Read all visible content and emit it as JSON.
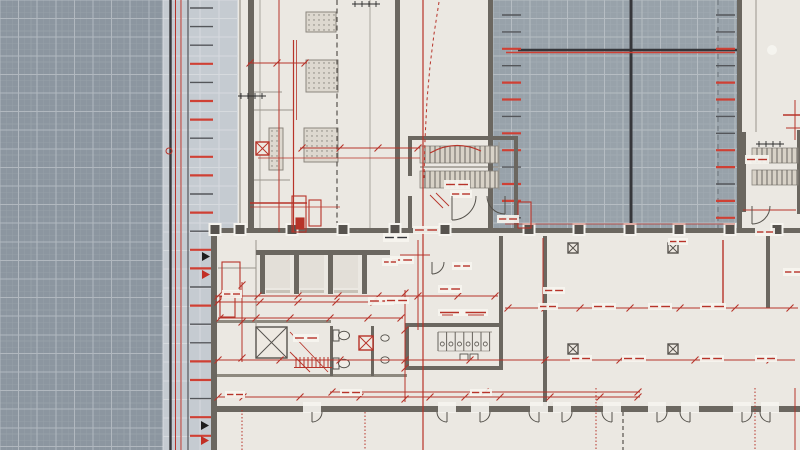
{
  "canvas": {
    "w": 800,
    "h": 450
  },
  "palette": {
    "paper": "#ebe8e2",
    "wall": "#6b6760",
    "wall_mid": "#8e897f",
    "line_gray": "#9a958c",
    "ink": "#35363a",
    "ink2": "#54565a",
    "red": "#b73329",
    "red_bright": "#cf4034",
    "tread": "#d8d2c7",
    "white": "#f6f4ef",
    "dot": "#6a665f",
    "fixture": "#55524c",
    "fixture_fill": "#f0ede7"
  },
  "grids": [
    {
      "name": "exterior-grid-left",
      "x": 0,
      "y": 0,
      "w": 163,
      "h": 450,
      "base": "#8c96a0",
      "minor": "#96a0a8",
      "major": "#b1b8bf",
      "ms": 6.2,
      "Ms": 18.6
    },
    {
      "name": "courtyard-grid",
      "x": 493,
      "y": 0,
      "w": 244,
      "h": 230,
      "base": "#98a2aa",
      "minor": "#a1aab1",
      "major": "#b6bdc3",
      "ms": 6.2,
      "Ms": 18.6
    }
  ],
  "bands": [
    {
      "name": "facade-band-upper",
      "x": 163,
      "y": 0,
      "w": 75,
      "h": 232,
      "base": "#c5cbd1",
      "line": "#d6dade",
      "Ms": 18.6
    },
    {
      "name": "facade-band-lower",
      "x": 163,
      "y": 232,
      "w": 48,
      "h": 218,
      "base": "#c5cbd1",
      "line": "#d6dade",
      "Ms": 18.6
    }
  ],
  "facade_lines": [
    [
      170.5,
      "ink",
      2.4
    ],
    [
      175.5,
      "red",
      1
    ],
    [
      181,
      "red",
      1
    ],
    [
      188,
      "ink2",
      1.2
    ]
  ],
  "facade_ticks": {
    "x1": 190,
    "x2": 213,
    "y0": 8,
    "step": 18.6,
    "colors": [
      "g",
      "g",
      "g",
      "r",
      "g",
      "r",
      "r",
      "g",
      "r",
      "r",
      "g",
      "r",
      "g",
      "r",
      "r",
      "g",
      "r",
      "g",
      "g",
      "r",
      "r",
      "g",
      "r",
      "r"
    ]
  },
  "court_ticks": [
    {
      "x1": 502,
      "x2": 521,
      "y0": 15,
      "step": 16.9,
      "colors": [
        "g",
        "g",
        "r",
        "g",
        "r",
        "r",
        "g",
        "r",
        "r",
        "g",
        "r",
        "r",
        "g"
      ]
    },
    {
      "x1": 716,
      "x2": 735,
      "y0": 15,
      "step": 16.9,
      "colors": [
        "g",
        "g",
        "r",
        "g",
        "r",
        "r",
        "g",
        "g",
        "r",
        "r",
        "g",
        "r",
        "r"
      ]
    }
  ],
  "court_cross": {
    "v": [
      631,
      0,
      230,
      3
    ],
    "h": [
      50,
      518,
      737,
      2.5
    ],
    "red_h": [
      52.5,
      506,
      735,
      1.5
    ],
    "dashed_v": [
      718,
      0,
      228
    ]
  },
  "walls": [
    [
      248,
      0,
      6,
      232
    ],
    [
      395,
      0,
      5,
      232
    ],
    [
      488,
      0,
      5,
      230
    ],
    [
      737,
      0,
      5,
      230
    ],
    [
      211,
      230,
      6,
      220
    ],
    [
      213,
      228,
      587,
      5
    ],
    [
      213,
      406,
      590,
      6
    ],
    [
      543,
      236,
      4,
      172
    ],
    [
      256,
      250,
      134,
      5
    ],
    [
      260,
      250,
      5,
      44
    ],
    [
      294,
      250,
      5,
      44
    ],
    [
      328,
      250,
      5,
      44
    ],
    [
      362,
      250,
      5,
      44
    ],
    [
      408,
      136,
      110,
      4
    ],
    [
      408,
      136,
      4,
      40
    ],
    [
      408,
      196,
      4,
      36
    ],
    [
      514,
      136,
      4,
      96
    ],
    [
      742,
      132,
      4,
      80
    ],
    [
      797,
      130,
      3,
      84
    ],
    [
      407,
      323,
      96,
      4
    ],
    [
      407,
      366,
      96,
      4
    ],
    [
      405,
      323,
      4,
      47
    ],
    [
      499,
      236,
      4,
      134
    ],
    [
      330,
      326,
      3,
      50
    ],
    [
      371,
      326,
      3,
      50
    ],
    [
      766,
      236,
      4,
      72
    ]
  ],
  "wall_mid_rects": [
    [
      213,
      320,
      118,
      3
    ],
    [
      213,
      374,
      194,
      3
    ]
  ],
  "wall_lines": [
    [
      240,
      0,
      240,
      232,
      1.2
    ],
    [
      260,
      0,
      260,
      232,
      0.8
    ],
    [
      370,
      0,
      370,
      232,
      0.8
    ],
    [
      248,
      92,
      282,
      92,
      1
    ],
    [
      248,
      110,
      294,
      110,
      1
    ],
    [
      254,
      180,
      290,
      180,
      1
    ],
    [
      756,
      0,
      756,
      132,
      1
    ],
    [
      499,
      142,
      499,
      190,
      1
    ],
    [
      420,
      167,
      498,
      167,
      1.4
    ],
    [
      218,
      268,
      256,
      268,
      1
    ],
    [
      256,
      240,
      256,
      330,
      1
    ],
    [
      438,
      332,
      492,
      332,
      1
    ],
    [
      438,
      351,
      490,
      351,
      0.8
    ]
  ],
  "dashed_dark": [
    [
      337,
      0,
      337,
      232,
      "5 3.5",
      1.2
    ],
    [
      623,
      412,
      623,
      450,
      "4 3",
      1.2
    ]
  ],
  "red_lines": [
    [
      423,
      0,
      423,
      450,
      1.2
    ],
    [
      258,
      158,
      420,
      158,
      0.8
    ],
    [
      250,
      203,
      307,
      203,
      1.6
    ],
    [
      250,
      207,
      340,
      207,
      0.8
    ],
    [
      279,
      0,
      279,
      232,
      1
    ],
    [
      293.5,
      40,
      293.5,
      232,
      1.2
    ],
    [
      296.5,
      40,
      296.5,
      120,
      0.8
    ],
    [
      543,
      238,
      543,
      307,
      1
    ],
    [
      723,
      240,
      723,
      307,
      1.4
    ],
    [
      783,
      115,
      800,
      115,
      1.5
    ],
    [
      786,
      128,
      800,
      128,
      1
    ],
    [
      795,
      100,
      795,
      140,
      1
    ],
    [
      418,
      240,
      418,
      330,
      1
    ],
    [
      400,
      255,
      430,
      255,
      1
    ],
    [
      743,
      210,
      796,
      210,
      1
    ],
    [
      795,
      388,
      795,
      450,
      1
    ],
    [
      505,
      224,
      735,
      224,
      0.8
    ]
  ],
  "red_dotted": [
    [
      242,
      410,
      242,
      450
    ],
    [
      365,
      412,
      365,
      450
    ],
    [
      596,
      388,
      596,
      450
    ],
    [
      755,
      388,
      755,
      450
    ]
  ],
  "red_paths": [
    {
      "d": "M439,2 L434,34 L430,66 L427,100 L425,140 L424,178",
      "dash": "3 3",
      "w": 1
    },
    {
      "d": "M430,153 Q455,139 481,151",
      "dash": "",
      "w": 1.1
    }
  ],
  "red_rects": [
    [
      292,
      196,
      14,
      36,
      0
    ],
    [
      309,
      200,
      12,
      26,
      0
    ],
    [
      296,
      218,
      8,
      11,
      1
    ],
    [
      222,
      262,
      18,
      30,
      0
    ],
    [
      220,
      297,
      15,
      20,
      0
    ],
    [
      518,
      202,
      13,
      26,
      0
    ]
  ],
  "dotted_rects": [
    [
      306,
      12,
      30,
      20
    ],
    [
      306,
      60,
      32,
      32
    ],
    [
      304,
      128,
      34,
      34
    ],
    [
      269,
      128,
      14,
      42
    ]
  ],
  "xboxes": [
    [
      256,
      142,
      13,
      "red"
    ],
    [
      256,
      327,
      31,
      "gray"
    ],
    [
      568,
      243,
      10,
      "gray"
    ],
    [
      668,
      243,
      10,
      "gray"
    ],
    [
      568,
      344,
      10,
      "gray"
    ],
    [
      668,
      344,
      10,
      "gray"
    ],
    [
      359,
      336,
      14,
      "red"
    ]
  ],
  "columns": {
    "y": 225,
    "s": 9,
    "xs": [
      215,
      240,
      292,
      343,
      395,
      445,
      529,
      579,
      630,
      679,
      730,
      777
    ]
  },
  "stairs": [
    [
      420,
      146,
      78,
      17,
      5
    ],
    [
      420,
      171,
      78,
      17,
      5
    ],
    [
      752,
      148,
      46,
      15,
      5
    ],
    [
      752,
      170,
      46,
      15,
      5
    ]
  ],
  "door_arcs": [
    [
      452,
      196,
      24,
      "se"
    ],
    [
      505,
      196,
      18,
      "sw"
    ],
    [
      752,
      206,
      18,
      "se"
    ],
    [
      432,
      262,
      12,
      "se"
    ],
    [
      312,
      412,
      10,
      "se"
    ],
    [
      447,
      412,
      10,
      "sw"
    ],
    [
      480,
      412,
      10,
      "se"
    ],
    [
      539,
      412,
      10,
      "sw"
    ],
    [
      562,
      412,
      10,
      "se"
    ],
    [
      612,
      412,
      10,
      "sw"
    ],
    [
      657,
      412,
      10,
      "se"
    ],
    [
      690,
      412,
      10,
      "sw"
    ],
    [
      742,
      412,
      10,
      "se"
    ],
    [
      770,
      412,
      10,
      "sw"
    ]
  ],
  "door_halos": [
    312,
    447,
    480,
    539,
    562,
    612,
    657,
    690,
    742,
    770
  ],
  "dims": [
    {
      "o": "h",
      "p": 296,
      "a": 215,
      "b": 498,
      "t": [
        218,
        258,
        298,
        338,
        378,
        418,
        458,
        495
      ]
    },
    {
      "o": "h",
      "p": 308,
      "a": 505,
      "b": 798,
      "t": [
        508,
        545,
        580,
        630,
        680,
        735,
        790
      ]
    },
    {
      "o": "h",
      "p": 360,
      "a": 215,
      "b": 795,
      "t": [
        218,
        280,
        340,
        405,
        470,
        545,
        620,
        695,
        770
      ]
    },
    {
      "o": "h",
      "p": 397,
      "a": 218,
      "b": 640,
      "t": [
        218,
        243,
        300,
        360,
        430,
        465,
        500,
        550,
        600,
        638
      ]
    },
    {
      "o": "h",
      "p": 302,
      "a": 215,
      "b": 395,
      "t": [
        218,
        260,
        298,
        336,
        374
      ]
    },
    {
      "o": "h",
      "p": 318,
      "a": 218,
      "b": 403,
      "t": [
        220,
        256,
        290,
        330,
        368,
        401
      ]
    },
    {
      "o": "v",
      "p": 405,
      "a": 290,
      "b": 402,
      "t": [
        293,
        330,
        368,
        399
      ]
    },
    {
      "o": "v",
      "p": 242,
      "a": 282,
      "b": 362,
      "t": [
        285,
        322,
        358
      ]
    },
    {
      "o": "h",
      "p": 148,
      "a": 300,
      "b": 420,
      "t": [
        302,
        340,
        378,
        418
      ]
    },
    {
      "o": "h",
      "p": 392,
      "a": 330,
      "b": 640,
      "t": [
        332,
        485,
        638
      ]
    },
    {
      "o": "h",
      "p": 63,
      "a": 248,
      "b": 307,
      "t": [
        250,
        277,
        305
      ]
    }
  ],
  "halos": [
    [
      444,
      180,
      26,
      9,
      "r"
    ],
    [
      450,
      190,
      22,
      8,
      "r"
    ],
    [
      383,
      233,
      26,
      9,
      "k"
    ],
    [
      390,
      256,
      24,
      8,
      "r"
    ],
    [
      413,
      226,
      26,
      8,
      "r"
    ],
    [
      497,
      215,
      22,
      8,
      "r"
    ],
    [
      452,
      262,
      20,
      8,
      "r"
    ],
    [
      438,
      285,
      24,
      8,
      "r"
    ],
    [
      368,
      297,
      26,
      8,
      "r"
    ],
    [
      293,
      334,
      26,
      8,
      "r"
    ],
    [
      438,
      309,
      50,
      7,
      "r"
    ],
    [
      222,
      290,
      20,
      8,
      "r"
    ],
    [
      538,
      303,
      20,
      7,
      "r"
    ],
    [
      592,
      303,
      24,
      7,
      "r"
    ],
    [
      648,
      303,
      24,
      7,
      "r"
    ],
    [
      700,
      303,
      26,
      7,
      "r"
    ],
    [
      570,
      355,
      22,
      7,
      "r"
    ],
    [
      622,
      355,
      24,
      7,
      "r"
    ],
    [
      700,
      355,
      24,
      7,
      "r"
    ],
    [
      755,
      355,
      22,
      7,
      "r"
    ],
    [
      225,
      391,
      20,
      7,
      "r"
    ],
    [
      340,
      389,
      22,
      7,
      "r"
    ],
    [
      470,
      389,
      22,
      7,
      "r"
    ],
    [
      745,
      155,
      24,
      9,
      "r"
    ],
    [
      755,
      228,
      20,
      8,
      "r"
    ],
    [
      382,
      258,
      16,
      8,
      "r"
    ],
    [
      385,
      297,
      24,
      7,
      "r"
    ],
    [
      668,
      238,
      20,
      7,
      "r"
    ],
    [
      783,
      268,
      20,
      8,
      "r"
    ],
    [
      543,
      287,
      22,
      7,
      "r"
    ]
  ],
  "triangles": [
    [
      202,
      252,
      "k"
    ],
    [
      202,
      270,
      "r"
    ],
    [
      201,
      421,
      "k"
    ],
    [
      201,
      436,
      "r"
    ]
  ],
  "black_marks": [
    [
      238,
      96
    ],
    [
      756,
      144
    ],
    [
      352,
      4
    ]
  ],
  "red_circle": [
    169,
    151,
    3
  ],
  "white_circles": [
    [
      772,
      50,
      5
    ]
  ],
  "comb": {
    "x": 296,
    "y": 357,
    "n": 9,
    "step": 4,
    "h": 10
  },
  "red_diags": [
    [
      290,
      332,
      328,
      372
    ],
    [
      290,
      352,
      310,
      372
    ],
    [
      430,
      195,
      443,
      208
    ],
    [
      436,
      193,
      449,
      206
    ]
  ],
  "fixtures": {
    "shaft_inners": [
      [
        265,
        255,
        25,
        33
      ],
      [
        299,
        255,
        25,
        33
      ],
      [
        333,
        255,
        25,
        33
      ]
    ],
    "elevator_doors": [
      [
        266,
        290,
        24
      ],
      [
        300,
        290,
        24
      ],
      [
        334,
        290,
        24
      ]
    ],
    "toilets": [
      [
        333,
        330
      ],
      [
        333,
        358
      ]
    ],
    "stalls": {
      "x": 438,
      "y": 332,
      "n": 6,
      "w": 8.6,
      "h": 19
    },
    "sinks": [
      [
        460,
        354,
        8,
        6
      ],
      [
        470,
        354,
        8,
        6
      ]
    ],
    "basins": [
      [
        385,
        338
      ],
      [
        385,
        360
      ]
    ]
  }
}
